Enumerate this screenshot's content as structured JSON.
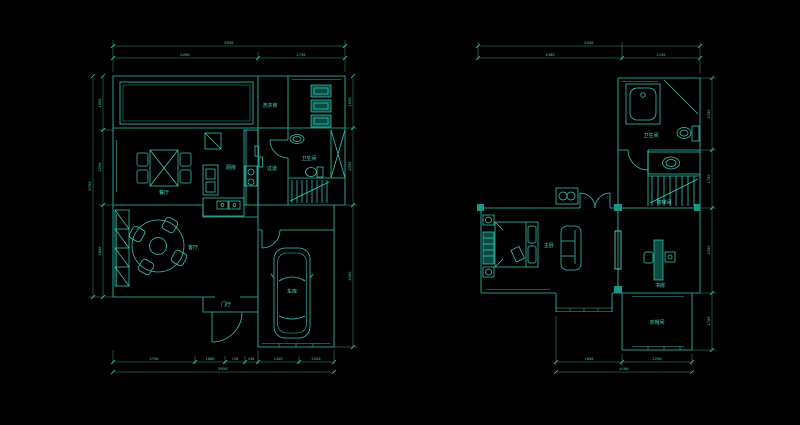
{
  "colors": {
    "background": "#000000",
    "wall": "#1e9488",
    "furniture": "#33cdbc",
    "dimension_line": "#2f9d72",
    "label_text": "#4adcc9"
  },
  "left_plan": {
    "labels": {
      "dining": "餐厅",
      "kitchen": "厨房",
      "corridor": "过道",
      "living": "客厅",
      "entry": "门厅",
      "garage": "车库",
      "bathroom": "卫生间",
      "laundry": "洗衣房"
    },
    "dimensions": {
      "top_total": "8950",
      "top_segments": [
        "6200",
        "2750"
      ],
      "bottom_segments": [
        "2750",
        "1080",
        "720",
        "430",
        "1450",
        "2520"
      ],
      "bottom_total": "8950",
      "left_segments": [
        "1650",
        "2250",
        "2800"
      ],
      "left_total": "6700",
      "right_segments": [
        "1650",
        "2350",
        "4300"
      ]
    }
  },
  "right_plan": {
    "labels": {
      "bathroom": "卫生间",
      "stairs": "楼梯间",
      "master_bedroom": "主卧",
      "study": "书房",
      "cloakroom": "衣帽间"
    },
    "dimensions": {
      "top_total": "6450",
      "top_segments": [
        "4300",
        "2150"
      ],
      "right_segments": [
        "2150",
        "1750",
        "2550",
        "1700"
      ],
      "bottom_segments": [
        "1850",
        "2250"
      ],
      "bottom_total": "4100"
    }
  }
}
